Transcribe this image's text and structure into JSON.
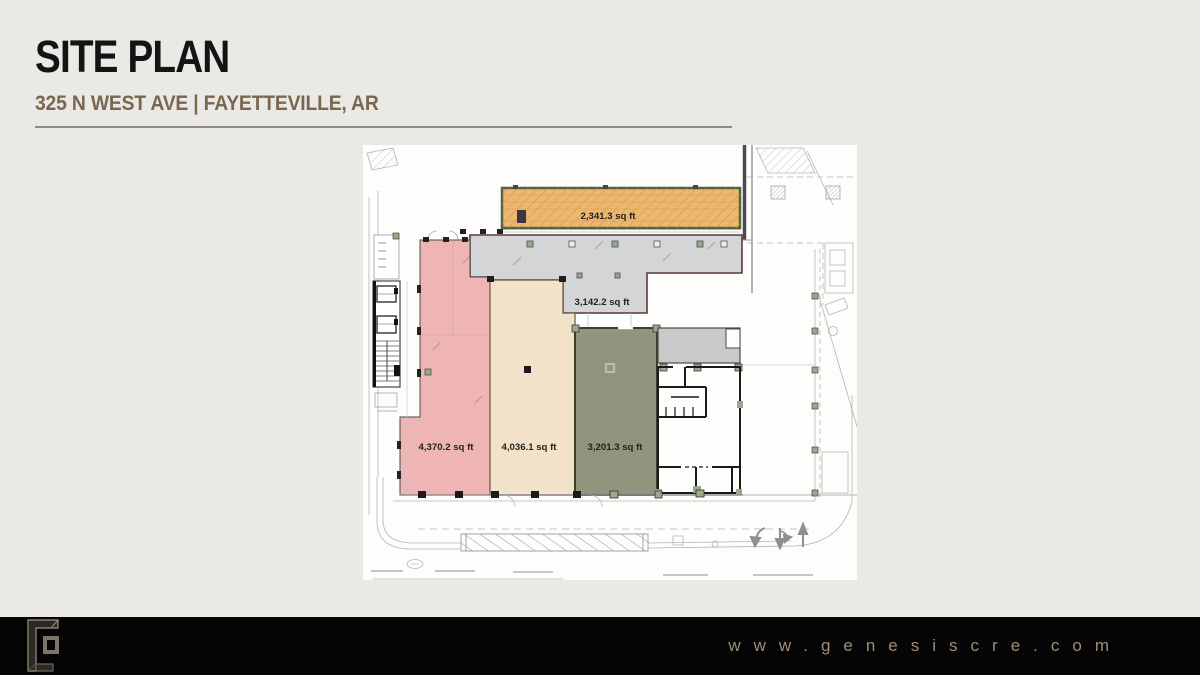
{
  "header": {
    "title": "SITE PLAN",
    "subtitle": "325 N WEST AVE | FAYETTEVILLE, AR"
  },
  "footer": {
    "website": "www.genesiscre.com",
    "logo": "genesis-g-logo"
  },
  "plan": {
    "description": "architectural site plan with leasable suites",
    "suites": [
      {
        "name": "north-suite",
        "area_label": "2,341.3 sq ft",
        "color": "#edb76f"
      },
      {
        "name": "common-area",
        "area_label": "3,142.2 sq ft",
        "color": "#d4d5d7"
      },
      {
        "name": "west-suite",
        "area_label": "4,370.2 sq ft",
        "color": "#efb5b5"
      },
      {
        "name": "center-suite",
        "area_label": "4,036.1 sq ft",
        "color": "#f3e2ca"
      },
      {
        "name": "east-suite",
        "area_label": "3,201.3 sq ft",
        "color": "#93947e"
      }
    ]
  },
  "colors": {
    "slide_background": "#ebe9e6",
    "title": "#141414",
    "subtitle": "#7a6750",
    "divider": "#8e8c88",
    "footer_background": "#050505",
    "footer_text": "#a08d77",
    "plan_background": "#fdfdfc",
    "orange_border": "#56613f",
    "common_border": "#5c3a35",
    "olive_border": "#3b3f2b",
    "column_green": "#9aa98a",
    "linework": "#b3b3b3"
  }
}
